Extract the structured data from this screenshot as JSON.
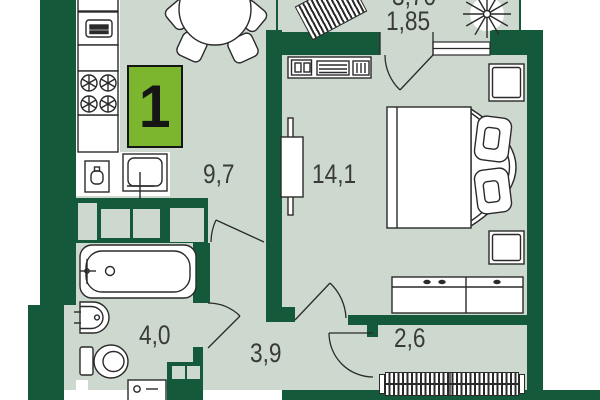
{
  "plan": {
    "apartment_badge": {
      "number": "1",
      "color": "#7cb52e"
    },
    "rooms": [
      {
        "name": "kitchen-living-room",
        "area_label": "9,7"
      },
      {
        "name": "bedroom",
        "area_label": "14,1"
      },
      {
        "name": "bathroom",
        "area_label": "4,0"
      },
      {
        "name": "hallway",
        "area_label": "3,9"
      },
      {
        "name": "storage-room",
        "area_label": "2,6"
      },
      {
        "name": "balcony",
        "area_label": "3,70",
        "area_label_reduced": "1,85"
      }
    ],
    "colors": {
      "wall": "#15593b",
      "floor": "#cdd9cf",
      "outline": "#2a2a2a",
      "background": "#ffffff",
      "badge_green": "#7cb52e"
    },
    "furniture": [
      "dining-table",
      "chairs",
      "fridge",
      "oven",
      "stove",
      "kitchen-sink",
      "kettle-unit",
      "bathtub",
      "washbasin",
      "toilet",
      "washing-machine",
      "bed",
      "pillows",
      "nightstands",
      "dresser",
      "tv-console",
      "sliding-panel",
      "wardrobe",
      "balcony-bench",
      "plant"
    ]
  }
}
